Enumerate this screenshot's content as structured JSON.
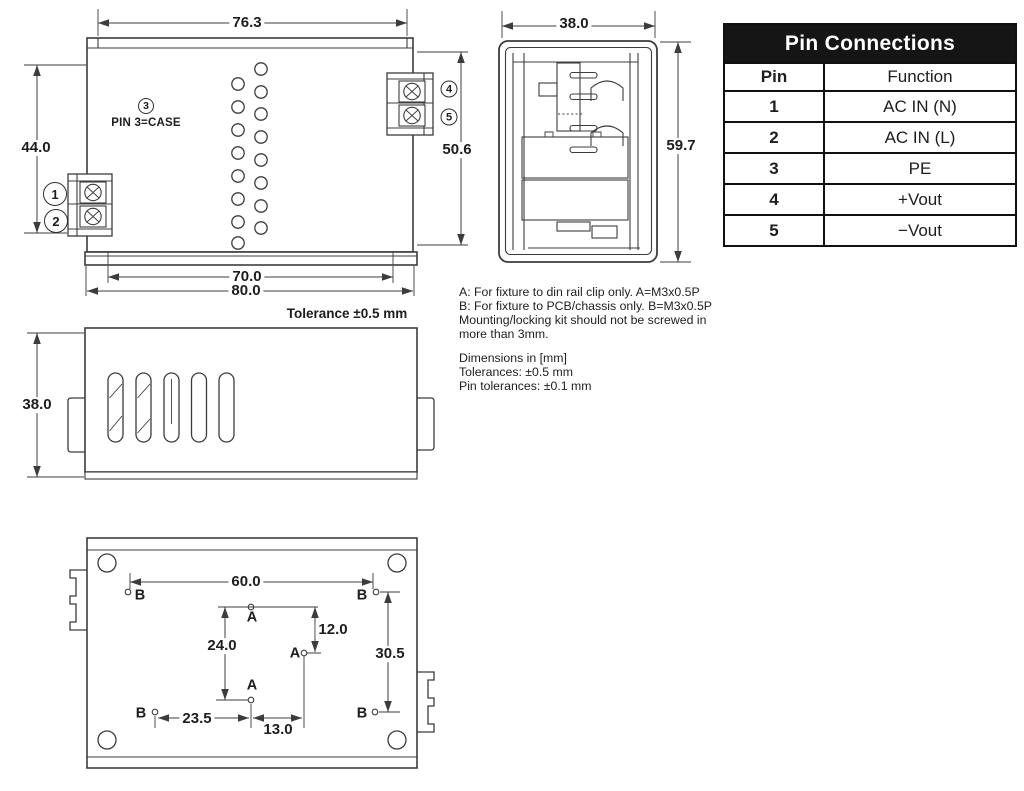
{
  "colors": {
    "drawing_line": "#3c3c3c",
    "table_border": "#111111",
    "table_header_bg": "#151515",
    "table_header_text": "#ffffff",
    "text": "#1d1d1d"
  },
  "pin_table": {
    "title": "Pin Connections",
    "col_pin": "Pin",
    "col_function": "Function",
    "rows": [
      {
        "pin": "1",
        "function": "AC IN (N)"
      },
      {
        "pin": "2",
        "function": "AC IN (L)"
      },
      {
        "pin": "3",
        "function": "PE"
      },
      {
        "pin": "4",
        "function": "+Vout"
      },
      {
        "pin": "5",
        "function": "−Vout"
      }
    ]
  },
  "notes": {
    "fixture_a": "A: For fixture to din rail clip only. A=M3x0.5P",
    "fixture_b": "B: For fixture to PCB/chassis only. B=M3x0.5P",
    "mounting_1": "Mounting/locking kit should not be screwed in",
    "mounting_2": "more than 3mm.",
    "dimensions": "Dimensions in [mm]",
    "tolerances": "Tolerances: ±0.5 mm",
    "pin_tolerances": "Pin tolerances: ±0.1 mm"
  },
  "front_view": {
    "dim_top_width": "76.3",
    "dim_left_height": "44.0",
    "dim_right_height": "50.6",
    "dim_bottom_inner_width": "70.0",
    "dim_bottom_outer_width": "80.0",
    "pin_1": "1",
    "pin_2": "2",
    "pin_3": "3",
    "pin_4": "4",
    "pin_5": "5",
    "pin3_case_label": "PIN 3=CASE"
  },
  "side_view": {
    "dim_width": "38.0",
    "dim_height": "59.7"
  },
  "top_view": {
    "dim_height": "38.0",
    "tolerance_note": "Tolerance ±0.5 mm"
  },
  "bottom_view": {
    "dim_hole_span_h": "60.0",
    "dim_a_span_v": "24.0",
    "dim_a_offset_v": "12.0",
    "dim_b_span_v": "30.5",
    "dim_b_offset_h": "23.5",
    "dim_a_offset_h": "13.0",
    "hole_a_label": "A",
    "hole_b_label": "B"
  }
}
